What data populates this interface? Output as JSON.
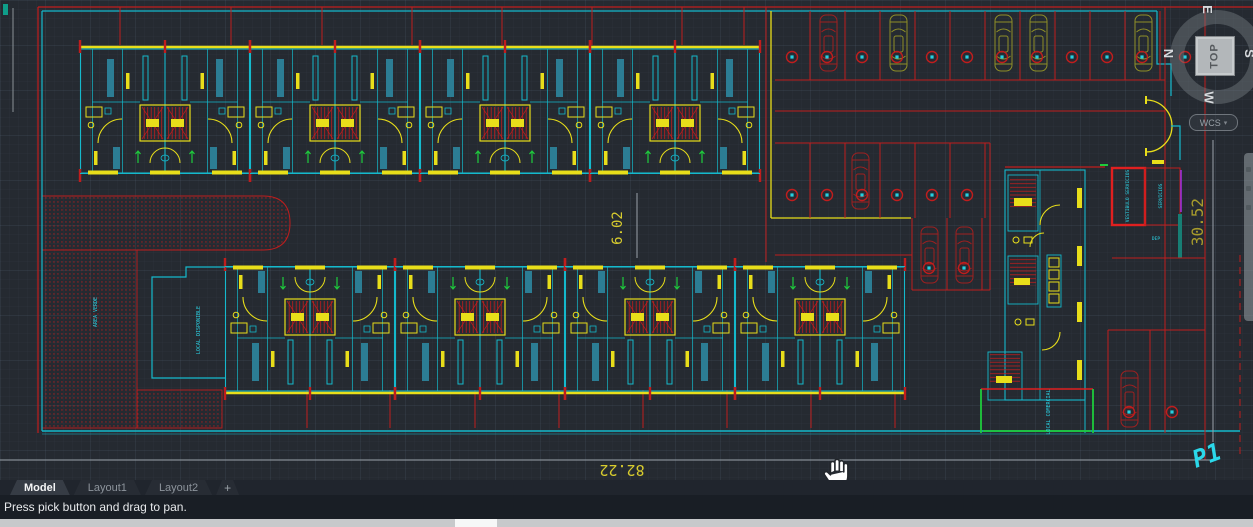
{
  "viewcube": {
    "face": "TOP",
    "north": "N",
    "east": "E",
    "south": "S",
    "west": "W",
    "wcs": "WCS",
    "caret": "▾"
  },
  "drawing": {
    "dim_width": "82.22",
    "dim_height": "30.52",
    "dim_gap": "6.02",
    "sheet_label": "P1",
    "labels": {
      "green_area": "AREA VERDE",
      "shop_left": "LOCAL DISPONIBLE",
      "service_room": "VESTIBULO SERVICIOS",
      "side_room": "SERVICIOS",
      "small_room": "DEP",
      "shop_right": "LOCAL COMERCIAL"
    },
    "colors": {
      "background": "#252a31",
      "wall_yellow": "#e8de1a",
      "partition_cyan": "#15b9cc",
      "grid_red": "#c01d1d",
      "green": "#1ecb3c",
      "purple": "#9b30d8",
      "car_olive": "#8f8f28",
      "dim_text": "#d8cc2e",
      "annotation_cyan": "#2bd8ea"
    }
  },
  "tabs": {
    "items": [
      {
        "label": "Model",
        "active": true
      },
      {
        "label": "Layout1",
        "active": false
      },
      {
        "label": "Layout2",
        "active": false
      }
    ],
    "add_label": "+"
  },
  "status_bar": {
    "message": "Press pick button and drag to pan."
  }
}
